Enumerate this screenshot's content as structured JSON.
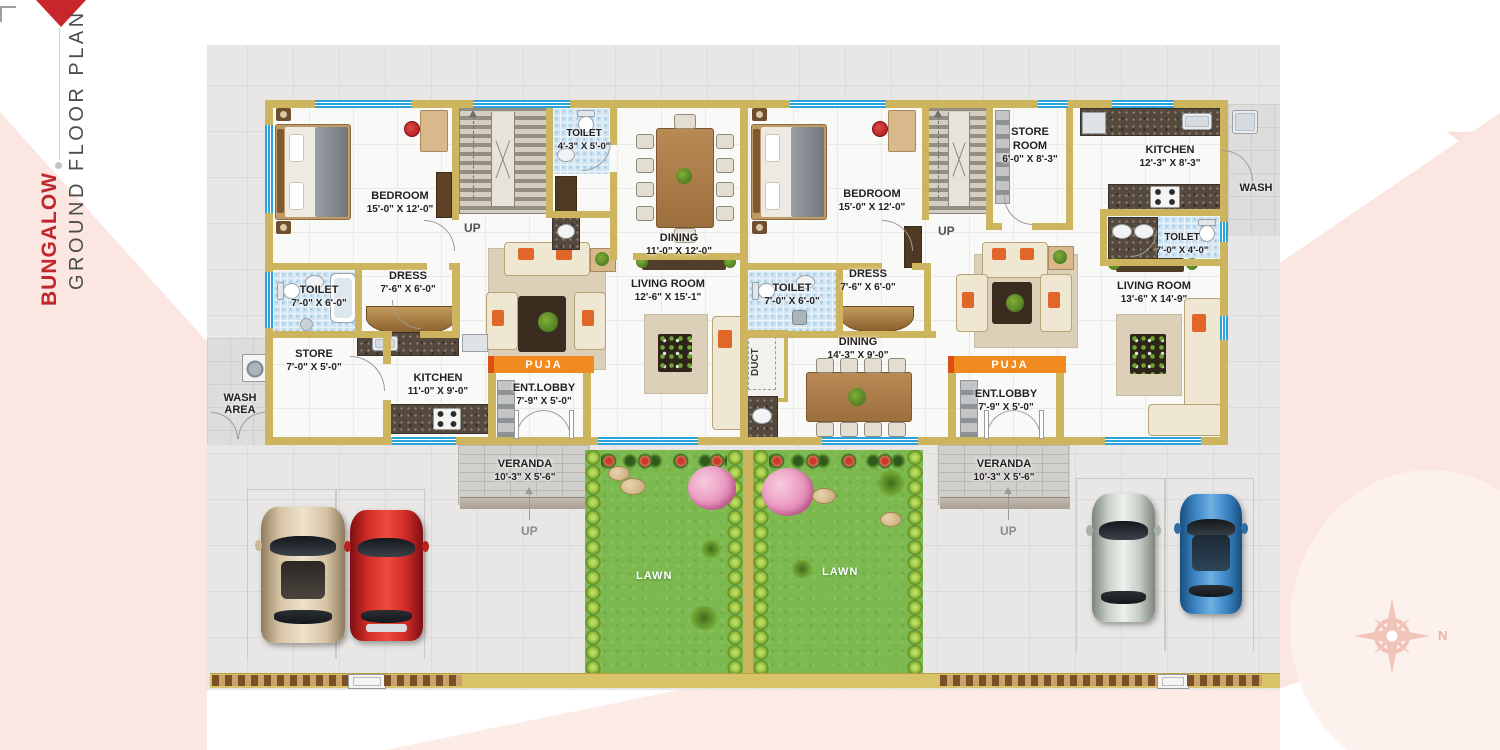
{
  "branding": {
    "title": "BUNGALOW",
    "subtitle": "GROUND FLOOR PLAN"
  },
  "compass": {
    "north": "N"
  },
  "shared": {
    "duct": "DUCT"
  },
  "unit_a": {
    "bedroom": {
      "name": "BEDROOM",
      "dims": "15'-0\" X 12'-0\""
    },
    "toilet_attached": {
      "name": "TOILET",
      "dims": "4'-3\" X 5'-0\""
    },
    "stairs_up": "UP",
    "dining": {
      "name": "DINING",
      "dims": "11'-0\" X 12'-0\""
    },
    "living": {
      "name": "LIVING ROOM",
      "dims": "12'-6\" X 15'-1\""
    },
    "toilet": {
      "name": "TOILET",
      "dims": "7'-0\" X 6'-0\""
    },
    "dress": {
      "name": "DRESS",
      "dims": "7'-6\" X 6'-0\""
    },
    "store": {
      "name": "STORE",
      "dims": "7'-0\" X 5'-0\""
    },
    "wash_area": "WASH\nAREA",
    "kitchen": {
      "name": "KITCHEN",
      "dims": "11'-0\" X 9'-0\""
    },
    "puja": "PUJA",
    "ent_lobby": {
      "name": "ENT.LOBBY",
      "dims": "7'-9\" X 5'-0\""
    },
    "veranda": {
      "name": "VERANDA",
      "dims": "10'-3\" X 5'-6\""
    },
    "veranda_up": "UP",
    "lawn": "LAWN"
  },
  "unit_b": {
    "bedroom": {
      "name": "BEDROOM",
      "dims": "15'-0\" X 12'-0\""
    },
    "stairs_up": "UP",
    "store_room": {
      "name": "STORE\nROOM",
      "dims": "6'-0\" X 8'-3\""
    },
    "kitchen": {
      "name": "KITCHEN",
      "dims": "12'-3\" X 8'-3\""
    },
    "wash": "WASH",
    "toilet_common": {
      "name": "TOILET",
      "dims": "7'-0\" X 4'-0\""
    },
    "living": {
      "name": "LIVING ROOM",
      "dims": "13'-6\" X 14'-9\""
    },
    "toilet": {
      "name": "TOILET",
      "dims": "7'-0\" X 6'-0\""
    },
    "dress": {
      "name": "DRESS",
      "dims": "7'-6\" X 6'-0\""
    },
    "dining": {
      "name": "DINING",
      "dims": "14'-3\" X 9'-0\""
    },
    "puja": "PUJA",
    "ent_lobby": {
      "name": "ENT.LOBBY",
      "dims": "7'-9\" X 5'-0\""
    },
    "veranda": {
      "name": "VERANDA",
      "dims": "10'-3\" X 5'-6\""
    },
    "veranda_up": "UP",
    "lawn": "LAWN"
  },
  "colors": {
    "accent_red": "#c0272d",
    "wall_gold": "#cdb45e",
    "window_blue": "#2aa3dc",
    "puja_orange": "#f18a1f",
    "lawn_green": "#7cb94e",
    "swoosh_pink": "#fbe6e2"
  }
}
